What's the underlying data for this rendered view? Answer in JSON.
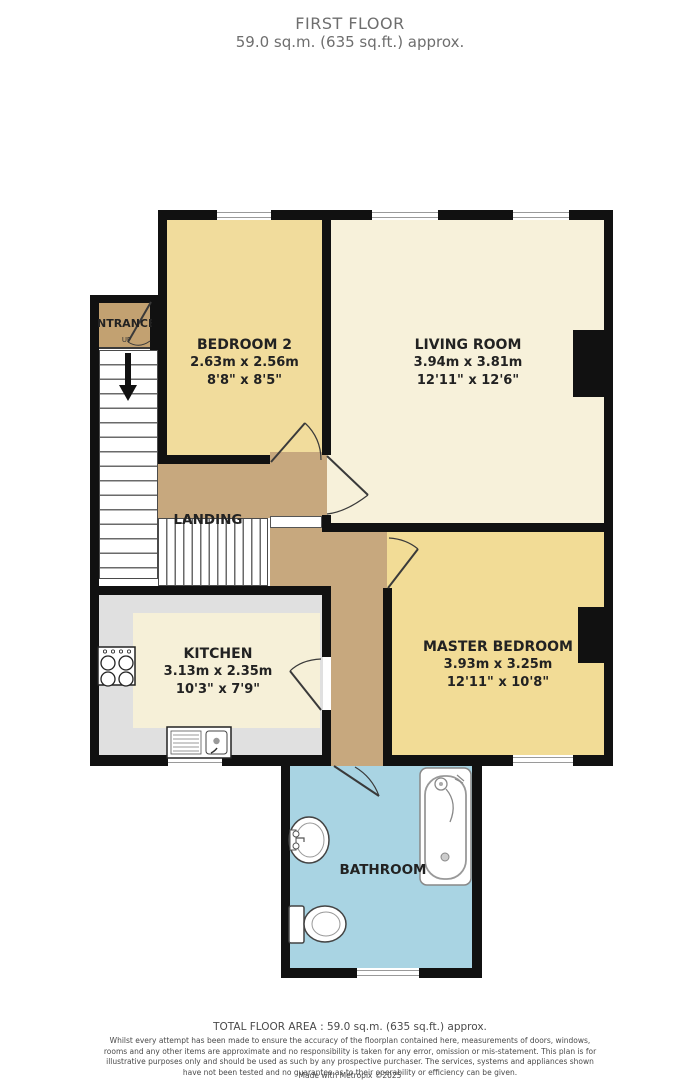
{
  "title": {
    "line1": "FIRST FLOOR",
    "line2": "59.0 sq.m. (635 sq.ft.) approx."
  },
  "rooms": {
    "bedroom2": {
      "name": "BEDROOM 2",
      "metric": "2.63m x 2.56m",
      "imperial": "8'8\" x 8'5\""
    },
    "living": {
      "name": "LIVING ROOM",
      "metric": "3.94m x 3.81m",
      "imperial": "12'11\" x 12'6\""
    },
    "kitchen": {
      "name": "KITCHEN",
      "metric": "3.13m x 2.35m",
      "imperial": "10'3\" x 7'9\""
    },
    "master": {
      "name": "MASTER BEDROOM",
      "metric": "3.93m x 3.25m",
      "imperial": "12'11\" x 10'8\""
    },
    "landing": {
      "name": "LANDING"
    },
    "bathroom": {
      "name": "BATHROOM"
    },
    "entrance": {
      "name": "NTRANCE",
      "up": "UP"
    }
  },
  "footer": {
    "total": "TOTAL FLOOR AREA : 59.0 sq.m. (635 sq.ft.) approx.",
    "disclaimer": "Whilst every attempt has been made to ensure the accuracy of the floorplan contained here, measurements of doors, windows, rooms and any other items are approximate and no responsibility is taken for any error, omission or mis-statement. This plan is for illustrative purposes only and should be used as such by any prospective purchaser. The services, systems and appliances shown have not been tested and no guarantee as to their operability or efficiency can be given.",
    "made_with": "Made with Metropix ©2025"
  },
  "colors": {
    "wall": "#111111",
    "bedroom2": "#F1DC9C",
    "living": "#F7F1DA",
    "master": "#F2DC96",
    "tan": "#C7A87E",
    "entrance": "#C2A171",
    "bathroom": "#A9D4E3",
    "counter": "#E0E0E0",
    "kitchenInner": "#F6F0D8"
  }
}
